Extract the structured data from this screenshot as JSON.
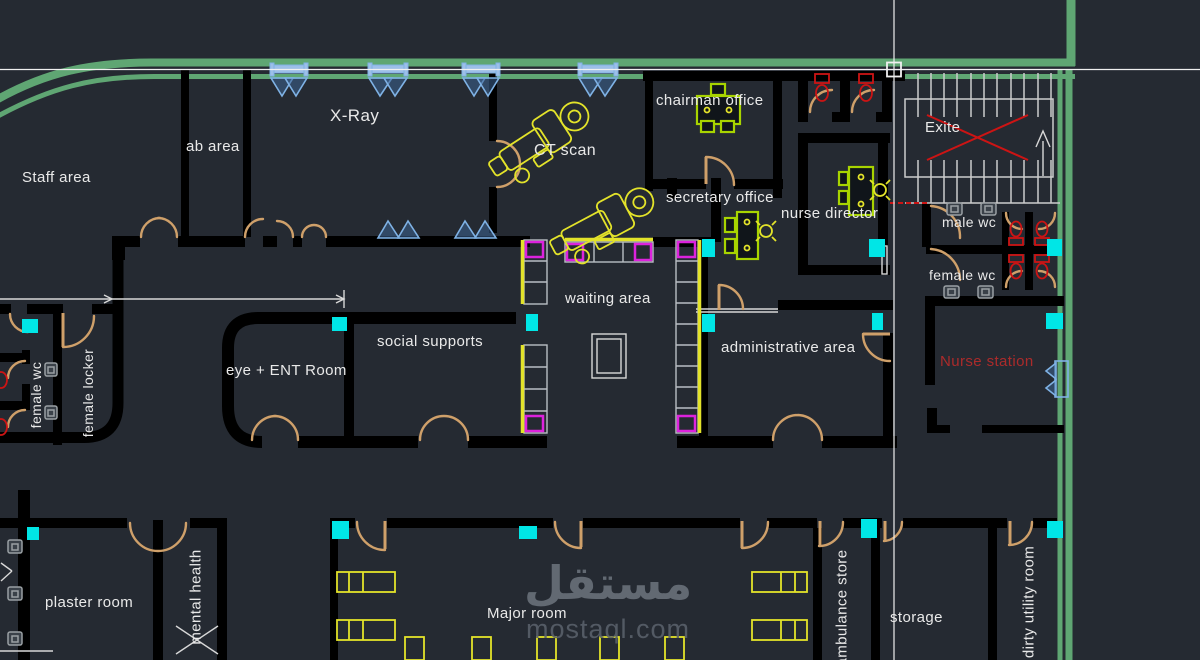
{
  "colors": {
    "background": "#252a32",
    "wall": "#000000",
    "road_green": "#5fa673",
    "door_tan": "#cfa06a",
    "label_text": "#e9e9e9",
    "cyan_light": "#00e6e6",
    "equipment_yellow": "#e3e32a",
    "desk_chartreuse": "#a8d400",
    "seat_magenta": "#dd22dd",
    "fixture_red": "#cc1414",
    "nurse_station_red": "#ab2b2b",
    "window_blue": "#7fb2e5",
    "stair_white": "#cccccc",
    "sink_gray": "#9aa0a4",
    "watermark_gray": "#6d747e",
    "crosshair_white": "#f0f0f0"
  },
  "labels": {
    "staff_area": "Staff area",
    "lab_area": "ab area",
    "xray": "X-Ray",
    "ct_scan": "CT scan",
    "chairman_office": "chairman office",
    "secretary_office": "secretary office",
    "nurse_director": "nurse director",
    "exit": "Exite",
    "male_wc": "male wc",
    "female_wc_right": "female wc",
    "waiting_area": "waiting area",
    "social_supports": "social supports",
    "eye_ent_room": "eye + ENT Room",
    "administrative_area": "administrative area",
    "nurse_station": "Nurse station",
    "female_wc_left": "female wc",
    "female_locker": "female locker",
    "plaster_room": "plaster room",
    "mental_health": "mental health",
    "major_room": "Major room",
    "ambulance_store": "ambulance store",
    "storage": "storage",
    "dirty_utility_room": "dirty utility room"
  },
  "watermark": {
    "arabic": "مستقل",
    "site": "mostaql.com"
  }
}
